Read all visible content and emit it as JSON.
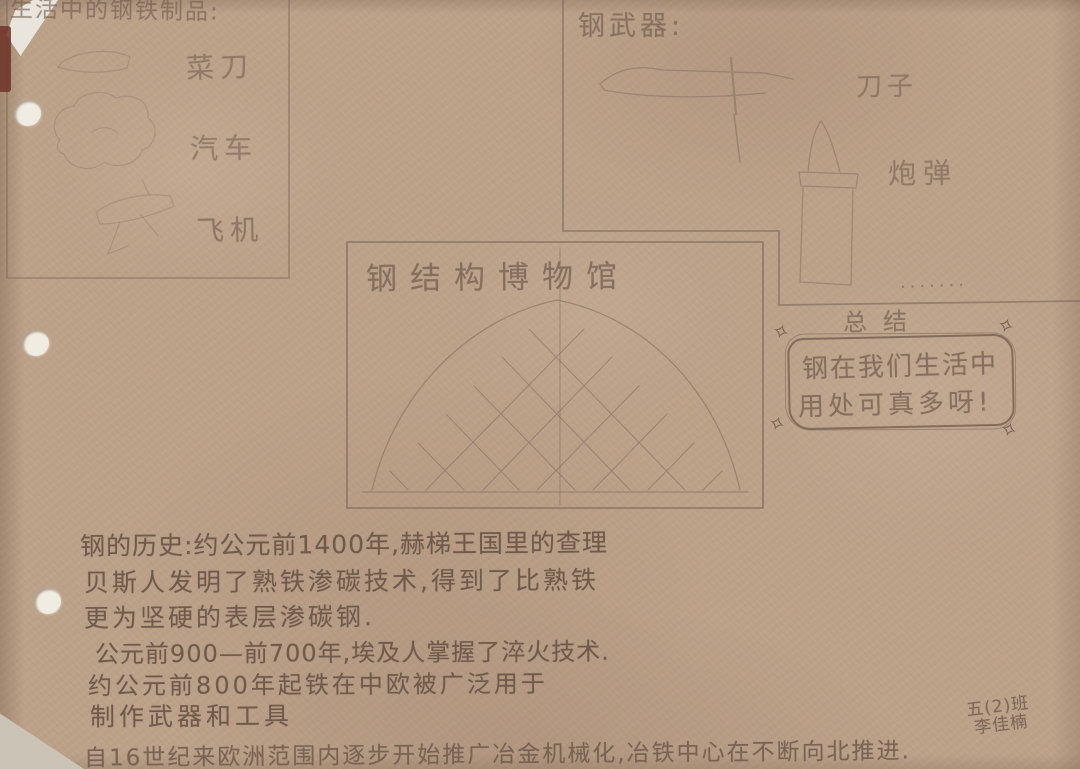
{
  "colors": {
    "paper": "#bca189",
    "pencil": "#6f5a4b",
    "pencil_light": "#937d6d",
    "hole": "#f1ece1"
  },
  "daily_items": {
    "title": "生活中的钢铁制品:",
    "labels": [
      "菜刀",
      "汽车",
      "飞机"
    ]
  },
  "weapons": {
    "title": "钢武器:",
    "labels": [
      "刀子",
      "炮弹"
    ],
    "ellipsis": "·······"
  },
  "museum": {
    "title": "钢结构博物馆"
  },
  "summary": {
    "heading": "总结",
    "lines": [
      "钢在我们生活中",
      "用处可真多呀!"
    ]
  },
  "history": {
    "lines": [
      "钢的历史:约公元前1400年,赫梯王国里的查理",
      "贝斯人发明了熟铁渗碳技术,得到了比熟铁",
      "更为坚硬的表层渗碳钢.",
      "公元前900—前700年,埃及人掌握了淬火技术.",
      "约公元前800年起铁在中欧被广泛用于",
      "制作武器和工具",
      "自16世纪来欧洲范围内逐步开始推广冶金机械化,冶铁中心在不断向北推进."
    ]
  },
  "signature": {
    "lines": [
      "五(2)班",
      "李佳楠"
    ]
  }
}
